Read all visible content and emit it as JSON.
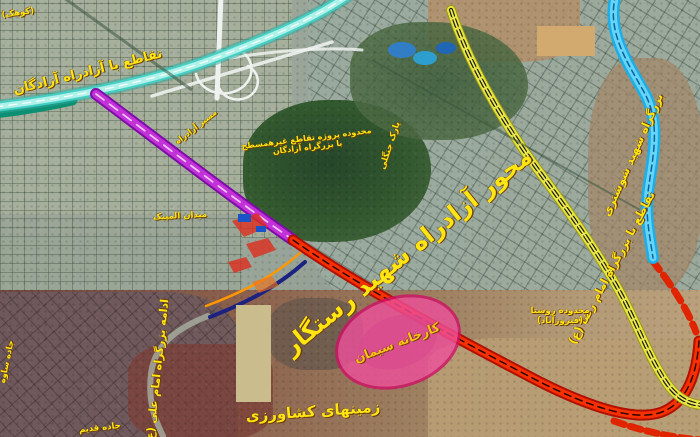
{
  "map": {
    "type": "satellite-annotated-road-map",
    "accent_colors": {
      "annotation_yellow": "#ffe512",
      "azadegan_teal": "#45cfc4",
      "axis_purple": "#c232d8",
      "axis_red": "#f73000",
      "yellow_highway": "#e8e63e",
      "blue_corridor": "#1caee6",
      "navy_link": "#1b2280",
      "orange_link": "#ff9800",
      "cement_zone_pink": "#ef4f9b",
      "masked_rect_tan": "#d2a96f"
    },
    "routes": [
      {
        "id": "azadegan-freeway",
        "color": "#45cfc4",
        "style": "multi-line teal band, top-left"
      },
      {
        "id": "main-axis-purple-segment",
        "color": "#c232d8",
        "style": "solid band, upper half of diagonal axis"
      },
      {
        "id": "main-axis-red-segment",
        "color": "#f73000",
        "style": "solid band with dark dashes, lower half and bottom arc"
      },
      {
        "id": "emam-reza-highway",
        "color": "#e8e63e",
        "style": "yellow band with black dashes, right diagonal"
      },
      {
        "id": "blue-corridor",
        "color": "#1caee6",
        "style": "light blue winding band, right edge"
      },
      {
        "id": "planned-link-navy",
        "color": "#1b2280",
        "style": "thin navy curve, center-bottom"
      },
      {
        "id": "planned-link-orange",
        "color": "#ff9800",
        "style": "thin orange curve, center-bottom"
      }
    ],
    "areas": [
      {
        "id": "cement-factory-zone",
        "shape": "ellipse",
        "color": "#ef4f9b"
      },
      {
        "id": "masked-rectangle-top-right",
        "shape": "rect",
        "color": "#d2a96f"
      },
      {
        "id": "masked-rectangle-bottom-center",
        "shape": "rect",
        "color": "#cbbc8d"
      },
      {
        "id": "forest-park",
        "shape": "blob",
        "color": "#2e5230"
      },
      {
        "id": "interchange-cloverleaf",
        "shape": "white ramps",
        "color": "#eef2f0"
      }
    ]
  },
  "labels": {
    "azadegan": {
      "text": "تقاطع با آزادراه آزادگان"
    },
    "main_axis": {
      "text": "محور آزادراه شهید رستگار"
    },
    "emam_reza": {
      "text": "تقاطع با بزرگراه امام رضا (ع)"
    },
    "shooshtari": {
      "text": "بزرگراه شهید شوشتری"
    },
    "cement": {
      "text": "کارخانه سیمان"
    },
    "agri": {
      "text": "زمینهای کشاورزی"
    },
    "emam_ali": {
      "text": "ادامه بزرگراه امام علی (ع)"
    },
    "project": {
      "line1": "محدوده پروژه تقاطع غیرهمسطح",
      "line2": "با بزرگراه آزادگان"
    },
    "phase": {
      "line1": "محدوده روستا",
      "line2": "(فیروزآباد)"
    },
    "park": {
      "text": "پارک جنگلی"
    },
    "azad_frag": {
      "text": "مسیر آزادراه"
    },
    "olympic": {
      "text": "میدان المپیک"
    },
    "corner": {
      "text": "(کوهک)"
    },
    "saveh": {
      "text": "جاده ساوه"
    },
    "ghadim": {
      "text": "جاده قدیم"
    }
  }
}
